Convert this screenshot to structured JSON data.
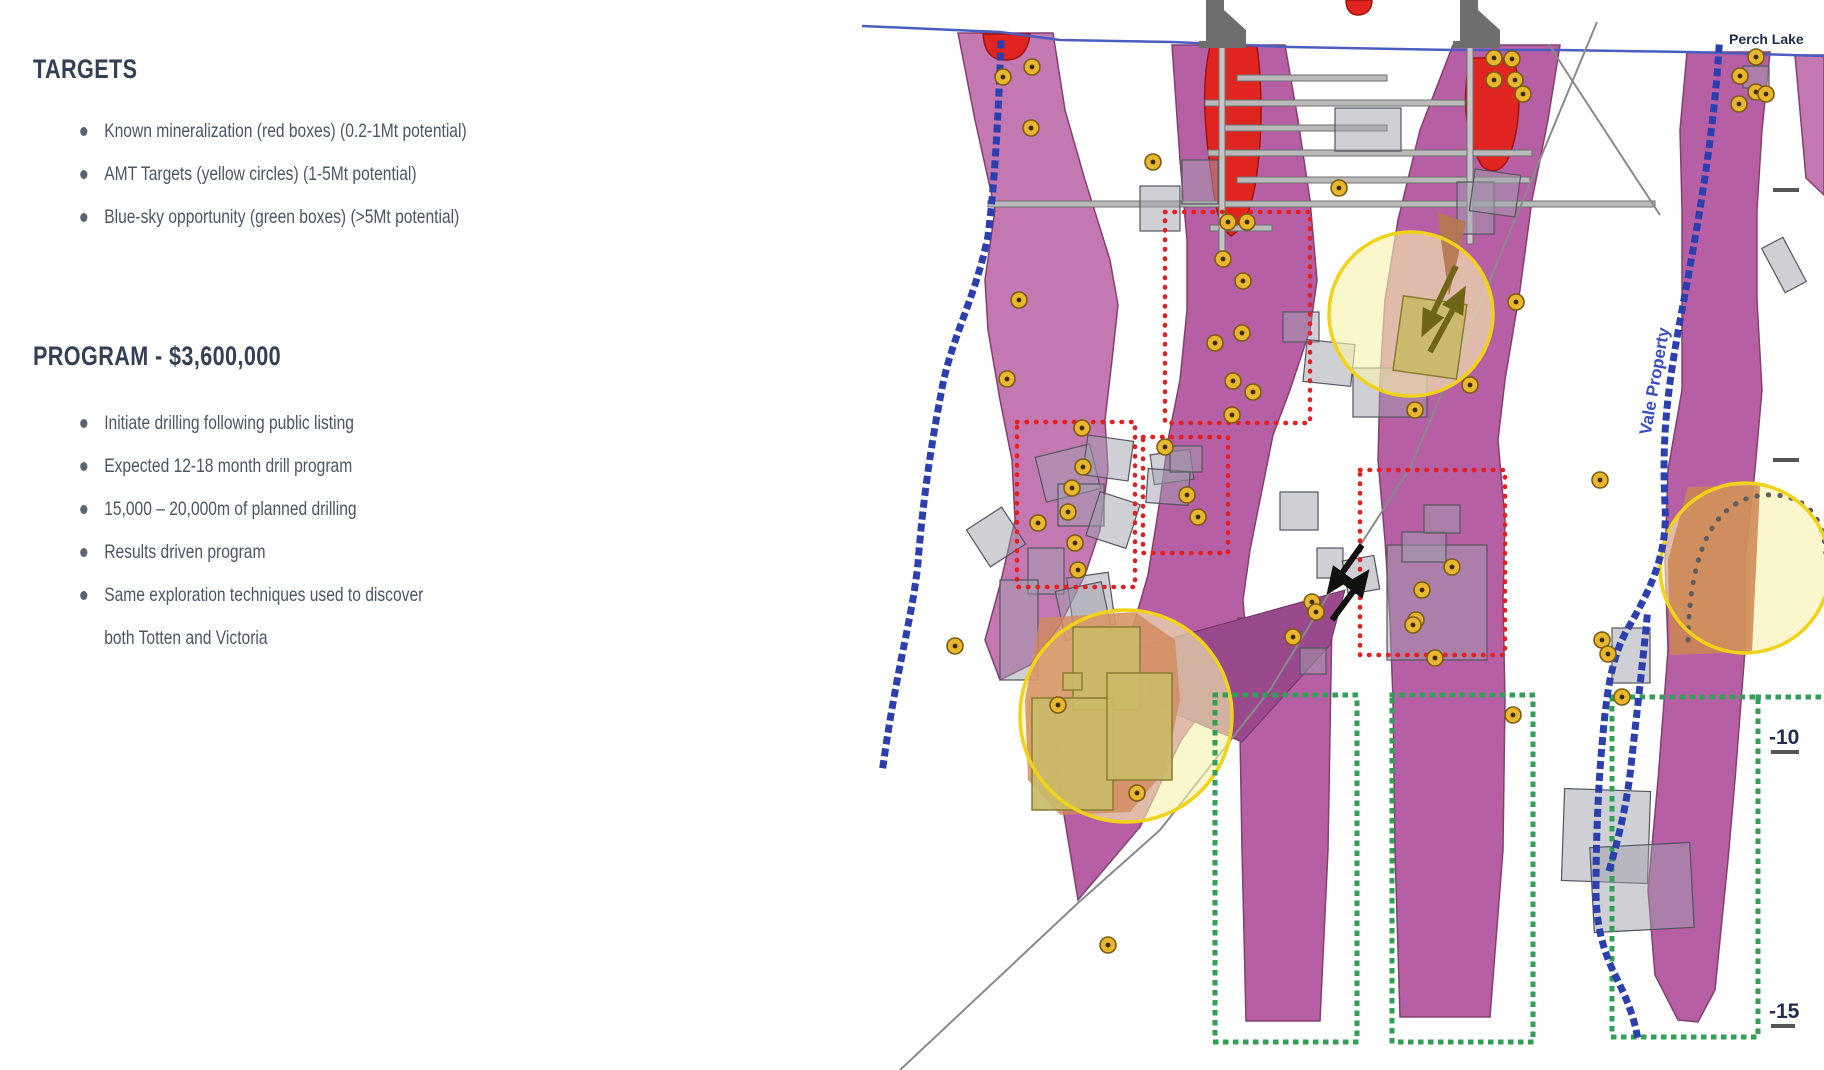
{
  "slide": {
    "sections": [
      {
        "heading": "TARGETS",
        "items": [
          "Known mineralization (red boxes) (0.2-1Mt potential)",
          "AMT Targets (yellow circles) (1-5Mt potential)",
          "Blue-sky opportunity (green boxes) (>5Mt potential)"
        ]
      },
      {
        "heading": "PROGRAM - $3,600,000",
        "items": [
          "Initiate drilling following public listing",
          "Expected 12-18 month drill program",
          "15,000 – 20,000m of planned drilling",
          "Results driven program",
          "Same exploration techniques used to discover\nboth Totten and Victoria"
        ]
      }
    ]
  },
  "diagram": {
    "labels": {
      "lake": "Perch Lake",
      "property": "Vale Property",
      "elev_a": "-10",
      "elev_b": "-15"
    },
    "legend": [
      {
        "name": "Known mineralization",
        "marker": "red-dotted-box",
        "potential": "0.2-1Mt"
      },
      {
        "name": "AMT Targets",
        "marker": "yellow-circle",
        "potential": "1-5Mt"
      },
      {
        "name": "Blue-sky opportunity",
        "marker": "green-dotted-box",
        "potential": ">5Mt"
      }
    ],
    "counts": {
      "red_boxes": 4,
      "large_amt_circles": 3,
      "green_boxes": 3,
      "small_amt_dots": 56
    }
  },
  "colors": {
    "heading": "#333f54",
    "body_text": "#4b5565",
    "bullet": "#5a6372",
    "dike": "#b75fa5",
    "dike_light": "#c478b2",
    "dike_dark": "#9a4a8c",
    "ore_red": "#e02420",
    "red_box": "#e32020",
    "green_box": "#2fa055",
    "amt_yellow": "#e9b62e",
    "circle_border": "#f0d318",
    "circle_fill": "#f8f2ae",
    "boundary_blue": "#2c3fae",
    "surface_blue": "#4a5ec2",
    "label_navy": "#1f2c50",
    "property_blue": "#3a4cc0",
    "gray_struct": "#b9b9b9",
    "khaki": "#c9ba67",
    "salmon": "#d28a5c",
    "orange": "#cd8650",
    "fault_gray": "#8a8a8a",
    "olive": "#6f6516"
  }
}
